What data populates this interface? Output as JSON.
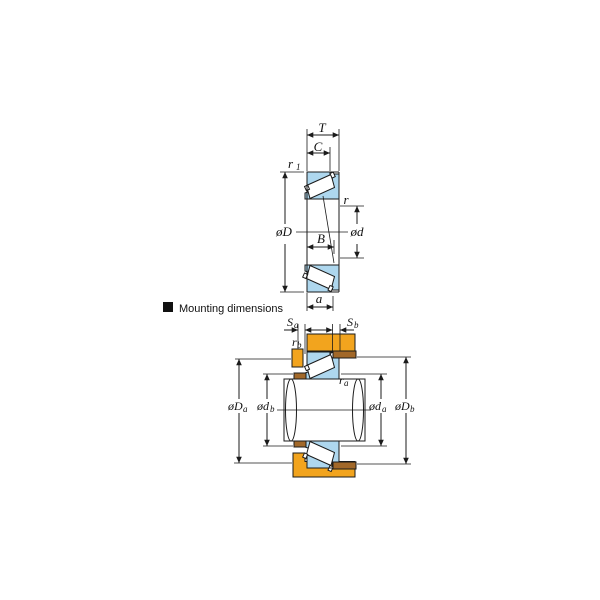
{
  "colors": {
    "line": "#1b1b1b",
    "bearing_ring_fill": "#aed7ee",
    "roller_fill": "#ffffff",
    "housing_fill": "#f2a41e",
    "spacer_fill": "#a26829",
    "background": "#ffffff"
  },
  "bearing_view": {
    "labels": {
      "T": "T",
      "C": "C",
      "r1": "r",
      "r1_sub": "1",
      "D": "øD",
      "r": "r",
      "d": "ød",
      "B": "B",
      "a": "a"
    }
  },
  "mounting_view": {
    "heading": "Mounting dimensions",
    "labels": {
      "Sa": "S",
      "Sa_sub": "a",
      "Sb": "S",
      "Sb_sub": "b",
      "rb": "r",
      "rb_sub": "b",
      "ra": "r",
      "ra_sub": "a",
      "Da": "øD",
      "Da_sub": "a",
      "db": "ød",
      "db_sub": "b",
      "da": "ød",
      "da_sub": "a",
      "Db": "øD",
      "Db_sub": "b"
    }
  }
}
